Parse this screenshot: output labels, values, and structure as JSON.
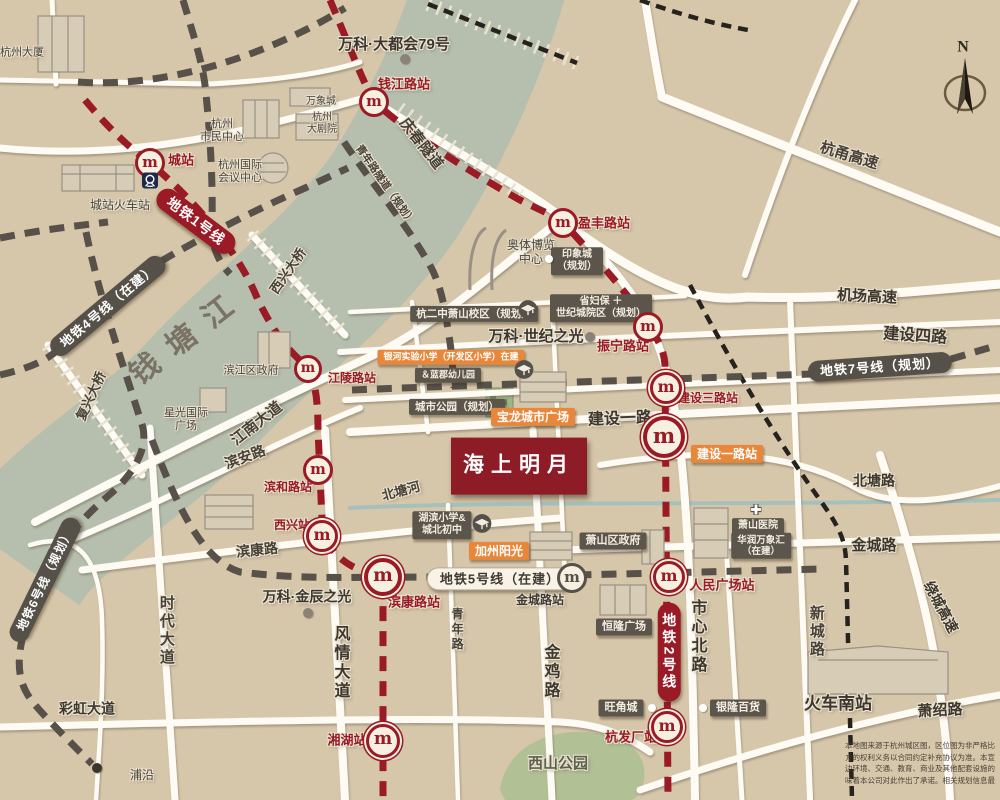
{
  "meta": {
    "colors": {
      "background": "#d6c7ab",
      "river": "#b6bfae",
      "road": "#fdfbf4",
      "metro_red": "#9a1b26",
      "metro_gray": "#57514a",
      "rail_black": "#26221d",
      "orange": "#e8873a",
      "dark_box": "#5b554c",
      "project_red": "#8e1c27"
    }
  },
  "project": {
    "name": "海上明月"
  },
  "compass_label": "N",
  "icons": {
    "metro_glyph": "m",
    "metro_red": [
      {
        "n": "station-icon-chengzhan",
        "x": 150,
        "y": 163,
        "s": 24
      },
      {
        "n": "station-icon-qianjianglu",
        "x": 374,
        "y": 102,
        "s": 24
      },
      {
        "n": "station-icon-yingfenglu",
        "x": 563,
        "y": 223,
        "s": 24
      },
      {
        "n": "station-icon-zhenninglu",
        "x": 648,
        "y": 327,
        "s": 24
      },
      {
        "n": "station-icon-jianshesanlu",
        "x": 666,
        "y": 388,
        "s": 26
      },
      {
        "n": "station-icon-jiansheyilu",
        "x": 664,
        "y": 437,
        "s": 34
      },
      {
        "n": "station-icon-jianglinglu",
        "x": 308,
        "y": 369,
        "s": 22
      },
      {
        "n": "station-icon-binhelu",
        "x": 318,
        "y": 470,
        "s": 24
      },
      {
        "n": "station-icon-xixing",
        "x": 322,
        "y": 536,
        "s": 26
      },
      {
        "n": "station-icon-binkanglu",
        "x": 383,
        "y": 577,
        "s": 30
      },
      {
        "n": "station-icon-xianghu",
        "x": 383,
        "y": 741,
        "s": 28
      },
      {
        "n": "station-icon-renminguangchang",
        "x": 669,
        "y": 577,
        "s": 26
      },
      {
        "n": "station-icon-hangfachang",
        "x": 667,
        "y": 727,
        "s": 26
      }
    ],
    "metro_gray": [
      {
        "n": "station-icon-jinchenglu",
        "x": 572,
        "y": 578,
        "s": 24
      }
    ],
    "dots": [
      {
        "n": "poi-dot-vanke-metropolis",
        "x": 405,
        "y": 59,
        "s": 10,
        "c": "#8a8276"
      },
      {
        "n": "poi-dot-vanke-century",
        "x": 590,
        "y": 337,
        "s": 10,
        "c": "#8a8276"
      },
      {
        "n": "poi-dot-vanke-jinchen",
        "x": 308,
        "y": 613,
        "s": 10,
        "c": "#8a8276"
      },
      {
        "n": "poi-dot-puyan",
        "x": 97,
        "y": 768,
        "s": 10,
        "c": "#3a352e"
      },
      {
        "n": "poi-dot-aoti",
        "x": 549,
        "y": 259,
        "s": 8,
        "c": "#ffffff"
      },
      {
        "n": "poi-dot-wangjiaocheng",
        "x": 652,
        "y": 708,
        "s": 8,
        "c": "#ffffff"
      },
      {
        "n": "poi-dot-yinlong",
        "x": 703,
        "y": 708,
        "s": 8,
        "c": "#ffffff"
      }
    ],
    "schools": [
      {
        "n": "school-icon-hangergzhong",
        "x": 528,
        "y": 312,
        "s": 20
      },
      {
        "n": "school-icon-yinhe",
        "x": 524,
        "y": 372,
        "s": 20
      },
      {
        "n": "school-icon-hubin",
        "x": 482,
        "y": 526,
        "s": 20
      }
    ],
    "hospital_cross": {
      "n": "hospital-cross-icon",
      "x": 756,
      "y": 512,
      "s": 13
    },
    "train_badge": {
      "n": "railway-station-icon",
      "x": 150,
      "y": 183,
      "s": 16
    }
  },
  "labels": [
    {
      "n": "hangzhou-tower-label",
      "t": "杭州大厦",
      "x": 22,
      "y": 53,
      "s": 11,
      "k": "lm"
    },
    {
      "n": "chengzhan-station-label",
      "t": "城站",
      "x": 181,
      "y": 160,
      "s": 13,
      "k": "str"
    },
    {
      "n": "chengzhan-railway-label",
      "t": "城站火车站",
      "x": 120,
      "y": 205,
      "s": 12,
      "k": "lm"
    },
    {
      "n": "citizen-center-label",
      "t": "杭州\n市民中心",
      "x": 222,
      "y": 131,
      "s": 11,
      "k": "lm"
    },
    {
      "n": "mixc-label",
      "t": "万象城",
      "x": 321,
      "y": 102,
      "s": 10,
      "k": "lm"
    },
    {
      "n": "grand-theatre-label",
      "t": "杭州\n大剧院",
      "x": 322,
      "y": 124,
      "s": 10,
      "k": "lm"
    },
    {
      "n": "intl-conference-label",
      "t": "杭州国际\n会议中心",
      "x": 240,
      "y": 172,
      "s": 11,
      "k": "lm"
    },
    {
      "n": "vanke-metropolis-label",
      "t": "万科·大都会79号",
      "x": 394,
      "y": 45,
      "s": 15,
      "k": "lmb"
    },
    {
      "n": "qianjiang-road-station-label",
      "t": "钱江路站",
      "x": 404,
      "y": 84,
      "s": 13,
      "k": "str"
    },
    {
      "n": "qingchun-tunnel-label",
      "t": "庆春隧道",
      "x": 421,
      "y": 144,
      "r": 52,
      "s": 15,
      "k": "rd"
    },
    {
      "n": "youth-road-tunnel-label",
      "t": "青年路隧道（规划）",
      "x": 385,
      "y": 185,
      "r": 55,
      "s": 10.5,
      "k": "rd"
    },
    {
      "n": "yingfeng-station-label",
      "t": "盈丰路站",
      "x": 604,
      "y": 223,
      "s": 13,
      "k": "str"
    },
    {
      "n": "aoti-expo-label",
      "t": "奥体博览\n中心",
      "x": 531,
      "y": 252,
      "s": 12,
      "k": "lm"
    },
    {
      "n": "yinxiangcheng-box",
      "t": "印象城\n（规划）",
      "x": 577,
      "y": 261,
      "s": 10,
      "k": "boxd"
    },
    {
      "n": "shengfubao-box",
      "t": "省妇保 ＋\n世纪城院区（规划）",
      "x": 601,
      "y": 308,
      "s": 10,
      "k": "boxd"
    },
    {
      "n": "hangerzhong-box",
      "t": "杭二中萧山校区（规划）",
      "x": 474,
      "y": 314,
      "s": 10.5,
      "k": "boxd"
    },
    {
      "n": "vanke-century-label",
      "t": "万科·世纪之光",
      "x": 536,
      "y": 337,
      "s": 15,
      "k": "lmb"
    },
    {
      "n": "zhenning-station-label",
      "t": "振宁路站",
      "x": 623,
      "y": 346,
      "s": 13,
      "k": "str"
    },
    {
      "n": "hangyong-expressway-label",
      "t": "杭甬高速",
      "x": 849,
      "y": 156,
      "r": 17,
      "s": 15,
      "k": "rd"
    },
    {
      "n": "airport-expressway-label",
      "t": "机场高速",
      "x": 867,
      "y": 297,
      "r": 3,
      "s": 15,
      "k": "rdb"
    },
    {
      "n": "line7-pill",
      "t": "地铁7号线（规划）",
      "x": 880,
      "y": 367,
      "r": -4,
      "s": 13,
      "k": "pilld"
    },
    {
      "n": "jianshe-4-road-label",
      "t": "建设四路",
      "x": 915,
      "y": 337,
      "r": 4,
      "s": 16,
      "k": "rdb"
    },
    {
      "n": "jianshe-3-station-label",
      "t": "建设三路站",
      "x": 708,
      "y": 398,
      "s": 12,
      "k": "str"
    },
    {
      "n": "yinhe-school-box",
      "t": "银河实验小学（开发区小学）在建",
      "x": 451,
      "y": 357,
      "s": 9,
      "k": "boxo"
    },
    {
      "n": "lanjun-kindergarten-box",
      "t": "＆蓝郡幼儿园",
      "x": 448,
      "y": 375,
      "s": 9,
      "k": "boxd"
    },
    {
      "n": "city-park-box",
      "t": "城市公园（规划）",
      "x": 457,
      "y": 407,
      "s": 10.5,
      "k": "boxd"
    },
    {
      "n": "baolong-plaza-box",
      "t": "宝龙城市广场",
      "x": 533,
      "y": 417,
      "s": 12,
      "k": "boxo"
    },
    {
      "n": "jianshe-1-road-label",
      "t": "建设一路",
      "x": 620,
      "y": 420,
      "r": -2,
      "s": 16,
      "k": "rdb"
    },
    {
      "n": "jianshe-1-station-box",
      "t": "建设一路站",
      "x": 727,
      "y": 454,
      "s": 12,
      "k": "boxo"
    },
    {
      "n": "project-name-box",
      "t": "海上明月",
      "x": 519,
      "y": 466,
      "s": 21,
      "k": "proj"
    },
    {
      "n": "jiangling-station-label",
      "t": "江陵路站",
      "x": 352,
      "y": 378,
      "s": 12,
      "k": "str"
    },
    {
      "n": "jiangnan-avenue-label",
      "t": "江南大道",
      "x": 257,
      "y": 424,
      "r": -38,
      "s": 15,
      "k": "rd"
    },
    {
      "n": "binan-road-label",
      "t": "滨安路",
      "x": 245,
      "y": 457,
      "r": -20,
      "s": 14,
      "k": "rd"
    },
    {
      "n": "binhe-station-label",
      "t": "滨和路站",
      "x": 288,
      "y": 487,
      "s": 12,
      "k": "str"
    },
    {
      "n": "xixing-station-label",
      "t": "西兴站",
      "x": 292,
      "y": 525,
      "s": 12,
      "k": "str"
    },
    {
      "n": "binkang-road-label",
      "t": "滨康路",
      "x": 257,
      "y": 550,
      "r": -6,
      "s": 14,
      "k": "rd"
    },
    {
      "n": "beitang-canal-label",
      "t": "北塘河",
      "x": 401,
      "y": 491,
      "r": -15,
      "s": 13,
      "k": "rd"
    },
    {
      "n": "beitang-road-label",
      "t": "北塘路",
      "x": 874,
      "y": 481,
      "s": 14,
      "k": "rdb"
    },
    {
      "n": "jincheng-road-label",
      "t": "金城路",
      "x": 874,
      "y": 546,
      "s": 15,
      "k": "rdb"
    },
    {
      "n": "hubin-school-box",
      "t": "湖滨小学&\n城北初中",
      "x": 442,
      "y": 525,
      "s": 10,
      "k": "boxd"
    },
    {
      "n": "california-sunshine-box",
      "t": "加州阳光",
      "x": 499,
      "y": 551,
      "s": 12,
      "k": "boxo"
    },
    {
      "n": "xiaoshan-government-box",
      "t": "萧山区政府",
      "x": 613,
      "y": 541,
      "s": 11,
      "k": "boxd"
    },
    {
      "n": "xiaoshan-hospital-box",
      "t": "萧山医院",
      "x": 758,
      "y": 526,
      "s": 10,
      "k": "boxd"
    },
    {
      "n": "huarun-mixc-box",
      "t": "华润万象汇\n（在建）",
      "x": 761,
      "y": 546,
      "s": 9.5,
      "k": "boxd"
    },
    {
      "n": "line5-pill",
      "t": "地铁5号线（在建）",
      "x": 500,
      "y": 579,
      "s": 13,
      "k": "pillw"
    },
    {
      "n": "jincheng-station-label",
      "t": "金城路站",
      "x": 540,
      "y": 600,
      "s": 12,
      "k": "std"
    },
    {
      "n": "binkang-station-label",
      "t": "滨康路站",
      "x": 414,
      "y": 602,
      "s": 13,
      "k": "str"
    },
    {
      "n": "vanke-jinchen-label",
      "t": "万科·金辰之光",
      "x": 307,
      "y": 597,
      "s": 14,
      "k": "lmb"
    },
    {
      "n": "renmin-square-station-label",
      "t": "人民广场站",
      "x": 722,
      "y": 585,
      "s": 13,
      "k": "str"
    },
    {
      "n": "henglong-plaza-box",
      "t": "恒隆广场",
      "x": 624,
      "y": 627,
      "s": 11,
      "k": "boxd"
    },
    {
      "n": "line2-pill",
      "t": "地铁2号线",
      "x": 669,
      "y": 652,
      "s": 14,
      "k": "pillrv"
    },
    {
      "n": "shixin-north-road-label",
      "t": "市心北路",
      "x": 696,
      "y": 637,
      "s": 16,
      "k": "rdbv"
    },
    {
      "n": "xincheng-road-label",
      "t": "新城路",
      "x": 816,
      "y": 632,
      "s": 15,
      "k": "rdv"
    },
    {
      "n": "raocheng-expressway-label",
      "t": "绕城高速",
      "x": 941,
      "y": 607,
      "r": 62,
      "s": 14,
      "k": "rdb"
    },
    {
      "n": "fengqing-avenue-label",
      "t": "风情大道",
      "x": 339,
      "y": 663,
      "s": 16,
      "k": "rdbv"
    },
    {
      "n": "qingnian-road-label",
      "t": "青年路",
      "x": 457,
      "y": 630,
      "s": 12,
      "k": "rdv"
    },
    {
      "n": "jinji-road-label",
      "t": "金鸡路",
      "x": 549,
      "y": 672,
      "s": 16,
      "k": "rdbv"
    },
    {
      "n": "shidai-avenue-label",
      "t": "时代大道",
      "x": 166,
      "y": 631,
      "s": 15,
      "k": "rdv"
    },
    {
      "n": "caihong-avenue-label",
      "t": "彩虹大道",
      "x": 87,
      "y": 709,
      "s": 14,
      "k": "rdb"
    },
    {
      "n": "line6-pill",
      "t": "地铁6号线（规划）",
      "x": 45,
      "y": 580,
      "r": -64,
      "s": 12,
      "k": "pilld"
    },
    {
      "n": "line4-pill",
      "t": "地铁4号线（在建）",
      "x": 108,
      "y": 306,
      "r": -40,
      "s": 13,
      "k": "pilld"
    },
    {
      "n": "line1-pill",
      "t": "地铁1号线",
      "x": 196,
      "y": 221,
      "r": 37,
      "s": 14,
      "k": "pillr"
    },
    {
      "n": "qiantang-river-label",
      "t": "钱塘江",
      "x": 188,
      "y": 336,
      "r": -38,
      "s": 30,
      "k": "river"
    },
    {
      "n": "fuxing-bridge-label",
      "t": "复兴大桥",
      "x": 91,
      "y": 396,
      "r": -65,
      "s": 13,
      "k": "rd"
    },
    {
      "n": "xixing-bridge-label",
      "t": "西兴大桥",
      "x": 288,
      "y": 271,
      "r": -55,
      "s": 13,
      "k": "rd"
    },
    {
      "n": "binjiang-government-label",
      "t": "滨江区政府",
      "x": 251,
      "y": 371,
      "s": 11,
      "k": "lm"
    },
    {
      "n": "xingguang-plaza-label",
      "t": "星光国际\n广场",
      "x": 186,
      "y": 420,
      "s": 11,
      "k": "lm"
    },
    {
      "n": "wangjiaocheng-box",
      "t": "旺角城",
      "x": 621,
      "y": 708,
      "s": 11,
      "k": "boxd"
    },
    {
      "n": "yinlong-store-box",
      "t": "银隆百货",
      "x": 738,
      "y": 708,
      "s": 11,
      "k": "boxd"
    },
    {
      "n": "hangfachang-station-label",
      "t": "杭发厂站",
      "x": 631,
      "y": 737,
      "s": 13,
      "k": "str"
    },
    {
      "n": "xianghu-station-label",
      "t": "湘湖站",
      "x": 347,
      "y": 740,
      "s": 13,
      "k": "str"
    },
    {
      "n": "xishan-park-label",
      "t": "西山公园",
      "x": 558,
      "y": 764,
      "s": 15,
      "k": "lmpark"
    },
    {
      "n": "south-railway-station-label",
      "t": "火车南站",
      "x": 838,
      "y": 704,
      "s": 17,
      "k": "lmb"
    },
    {
      "n": "xiaoshao-road-label",
      "t": "萧绍路",
      "x": 940,
      "y": 711,
      "r": -3,
      "s": 15,
      "k": "rdb"
    },
    {
      "n": "puyan-label",
      "t": "浦沿",
      "x": 142,
      "y": 775,
      "s": 12,
      "k": "lm"
    },
    {
      "n": "compass-n-label",
      "t": "N",
      "x": 963,
      "y": 48,
      "s": 16,
      "k": "compass"
    }
  ],
  "disclaimer": {
    "text": "本地图来源于杭州城区图，区位图为非严格比\n方的权利义务以合同约定补充协议为准。本宣\n边环境、交通、教育、商业及其他配套设施的\n味着本公司对此作出了承诺。相关规划信息最"
  }
}
